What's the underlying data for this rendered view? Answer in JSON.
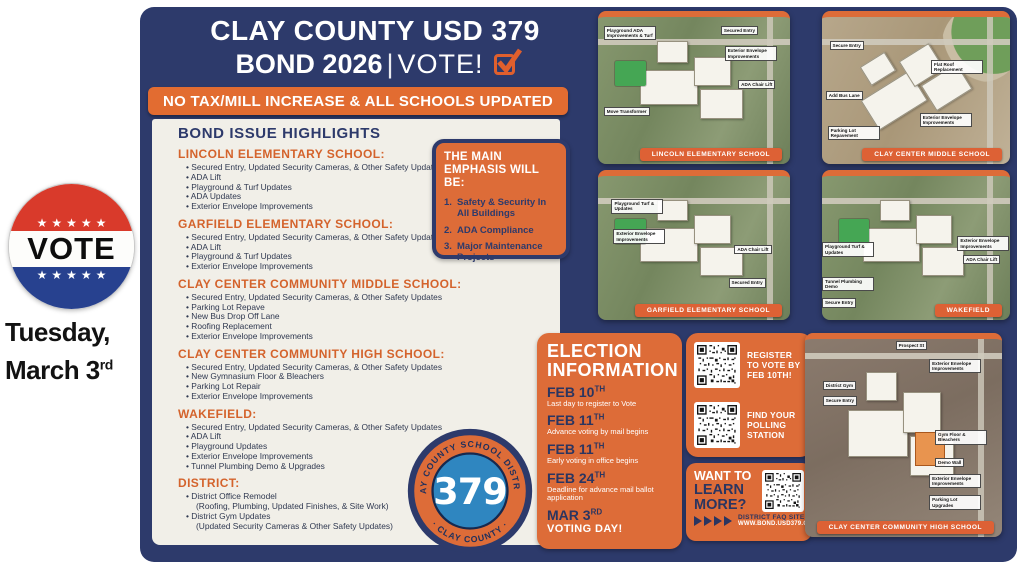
{
  "colors": {
    "navy": "#2d3a6b",
    "orange": "#dd6c38",
    "banner_orange": "#e2651f",
    "cream": "#f1efe8",
    "badge_red": "#d93a2b",
    "badge_blue": "#27418f",
    "logo_blue": "#2f86c0"
  },
  "header": {
    "title": "CLAY COUNTY USD 379",
    "bond": "BOND 2026",
    "sep": "|",
    "vote": "VOTE!",
    "banner": "NO TAX/MILL INCREASE & ALL SCHOOLS UPDATED"
  },
  "highlights": {
    "title": "BOND ISSUE HIGHLIGHTS",
    "sections": [
      {
        "name": "LINCOLN ELEMENTARY SCHOOL:",
        "items": [
          {
            "text": "Secured Entry, Updated Security Cameras, & Other Safety Updates"
          },
          {
            "text": "ADA Lift"
          },
          {
            "text": "Playground & Turf Updates"
          },
          {
            "text": "ADA Updates"
          },
          {
            "text": "Exterior Envelope Improvements"
          }
        ]
      },
      {
        "name": "GARFIELD ELEMENTARY SCHOOL:",
        "items": [
          {
            "text": "Secured Entry, Updated Security Cameras, & Other Safety Updates"
          },
          {
            "text": "ADA Lift"
          },
          {
            "text": "Playground & Turf Updates"
          },
          {
            "text": "Exterior Envelope Improvements"
          }
        ]
      },
      {
        "name": "CLAY CENTER COMMUNITY MIDDLE SCHOOL:",
        "items": [
          {
            "text": "Secured Entry, Updated Security Cameras, & Other Safety Updates"
          },
          {
            "text": "Parking Lot Repave"
          },
          {
            "text": "New Bus Drop Off Lane"
          },
          {
            "text": "Roofing Replacement"
          },
          {
            "text": "Exterior Envelope Improvements"
          }
        ]
      },
      {
        "name": "CLAY CENTER COMMUNITY HIGH SCHOOL:",
        "items": [
          {
            "text": "Secured Entry, Updated Security Cameras, & Other Safety Updates"
          },
          {
            "text": "New Gymnasium Floor & Bleachers"
          },
          {
            "text": "Parking Lot Repair"
          },
          {
            "text": "Exterior Envelope Improvements"
          }
        ]
      },
      {
        "name": "WAKEFIELD:",
        "items": [
          {
            "text": "Secured Entry, Updated Security Cameras, & Other Safety Updates"
          },
          {
            "text": "ADA Lift"
          },
          {
            "text": "Playground Updates"
          },
          {
            "text": "Exterior Envelope Improvements"
          },
          {
            "text": "Tunnel Plumbing Demo & Upgrades"
          }
        ]
      },
      {
        "name": "DISTRICT:",
        "items": [
          {
            "text": "District Office Remodel",
            "sub": "(Roofing, Plumbing, Updated Finishes, & Site Work)"
          },
          {
            "text": "District Gym Updates",
            "sub": "(Updated Security Cameras & Other Safety Updates)"
          }
        ]
      }
    ]
  },
  "emphasis": {
    "title": "THE MAIN EMPHASIS WILL BE:",
    "items": [
      "Safety & Security In All Buildings",
      "ADA Compliance",
      "Major Maintenance Projects"
    ]
  },
  "vote": {
    "stars": "★★★★★",
    "label": "VOTE",
    "date1": "Tuesday,",
    "date2": "March 3",
    "date2_sup": "rd"
  },
  "election": {
    "title1": "ELECTION",
    "title2": "INFORMATION",
    "entries": [
      {
        "d": "FEB 10",
        "s": "TH",
        "t": "Last day to register to Vote"
      },
      {
        "d": "FEB 11",
        "s": "TH",
        "t": "Advance voting by mail begins"
      },
      {
        "d": "FEB 11",
        "s": "TH",
        "t": "Early voting in office begins"
      },
      {
        "d": "FEB 24",
        "s": "TH",
        "t": "Deadline for advance mail ballot application"
      },
      {
        "d": "MAR 3",
        "s": "RD",
        "t": "VOTING DAY!",
        "cls": "big"
      }
    ]
  },
  "qr": {
    "items": [
      {
        "label": "REGISTER TO VOTE BY FEB 10TH!"
      },
      {
        "label": "FIND YOUR POLLING STATION"
      }
    ]
  },
  "learn": {
    "l1": "WANT TO",
    "l2": "LEARN",
    "l3": "MORE?",
    "faq": "DISTRICT FAQ SITE",
    "url": "WWW.BOND.USD379.ORG"
  },
  "maps": [
    {
      "label": "LINCOLN ELEMENTARY SCHOOL",
      "terrain": "t-green",
      "notes": [
        {
          "text": "Playground ADA Improvements & Turf",
          "x": 3,
          "y": 6
        },
        {
          "text": "Secured Entry",
          "x": 64,
          "y": 6
        },
        {
          "text": "Exterior Envelope Improvements",
          "x": 66,
          "y": 20
        },
        {
          "text": "ADA Chair Lift",
          "x": 73,
          "y": 43
        },
        {
          "text": "Move Transformer",
          "x": 3,
          "y": 61
        }
      ]
    },
    {
      "label": "CLAY CENTER MIDDLE SCHOOL",
      "terrain": "t-tan",
      "notes": [
        {
          "text": "Secure Entry",
          "x": 4,
          "y": 16
        },
        {
          "text": "Flat Roof Replacement",
          "x": 58,
          "y": 29
        },
        {
          "text": "Add Bus Lane",
          "x": 2,
          "y": 50
        },
        {
          "text": "Exterior Envelope Improvements",
          "x": 52,
          "y": 65
        },
        {
          "text": "Parking Lot Repavement",
          "x": 3,
          "y": 74
        }
      ]
    },
    {
      "label": "GARFIELD ELEMENTARY SCHOOL",
      "terrain": "t-green",
      "notes": [
        {
          "text": "Playground Turf & Updates",
          "x": 7,
          "y": 16
        },
        {
          "text": "Exterior Envelope Improvements",
          "x": 8,
          "y": 37
        },
        {
          "text": "ADA Chair Lift",
          "x": 71,
          "y": 48
        },
        {
          "text": "Secured Entry",
          "x": 68,
          "y": 71
        }
      ]
    },
    {
      "label": "WAKEFIELD",
      "terrain": "t-green",
      "notes": [
        {
          "text": "Playground Turf & Updates",
          "x": 0,
          "y": 46
        },
        {
          "text": "Exterior Envelope Improvements",
          "x": 72,
          "y": 42
        },
        {
          "text": "ADA Chair Lift",
          "x": 75,
          "y": 55
        },
        {
          "text": "Tunnel Plumbing Demo",
          "x": 0,
          "y": 70
        },
        {
          "text": "Secure Entry",
          "x": 0,
          "y": 85
        }
      ]
    },
    {
      "label": "CLAY CENTER COMMUNITY HIGH SCHOOL",
      "terrain": "t-brown",
      "notes": [
        {
          "text": "Prospect St",
          "x": 46,
          "y": 1
        },
        {
          "text": "Exterior Envelope Improvements",
          "x": 63,
          "y": 10
        },
        {
          "text": "District Gym",
          "x": 9,
          "y": 21
        },
        {
          "text": "Secure Entry",
          "x": 9,
          "y": 29
        },
        {
          "text": "Gym Floor & Bleachers",
          "x": 66,
          "y": 46
        },
        {
          "text": "Demo Wall",
          "x": 66,
          "y": 60
        },
        {
          "text": "Exterior Envelope Improvements",
          "x": 63,
          "y": 68
        },
        {
          "text": "Parking Lot Upgrades",
          "x": 63,
          "y": 79
        }
      ]
    }
  ],
  "logo": {
    "arc_top": "CLAY COUNTY SCHOOL DISTRICT",
    "number": "379",
    "arc_bottom": "· CLAY COUNTY ·"
  }
}
